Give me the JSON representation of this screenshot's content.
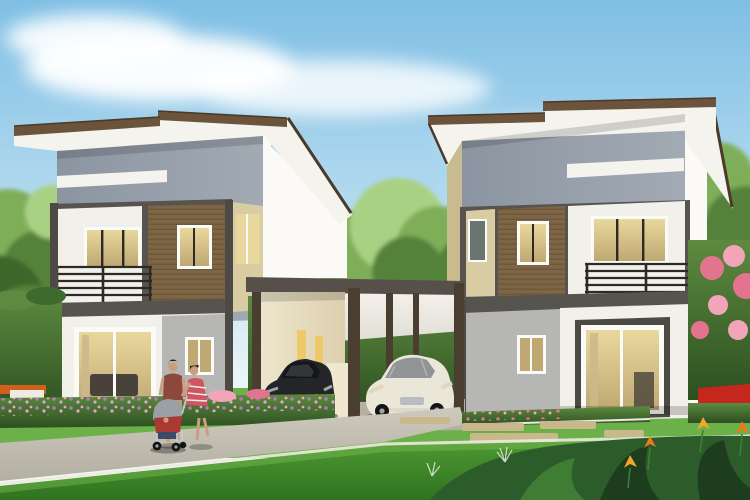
{
  "meta": {
    "type": "architectural-rendering",
    "subject": "Twin modern two-story houses with central carport, cars and family on walkway",
    "width_px": 750,
    "height_px": 500
  },
  "scene": {
    "sky": {
      "description": "light blue sky with soft clouds",
      "cloud_count": 4
    },
    "houses": [
      {
        "id": "left-house",
        "position": "left",
        "floors": 2,
        "features": [
          "brown-edged shed roof",
          "gray upper facade with white stripe",
          "balcony with dark railing",
          "wood-slat accent panel",
          "lit upper windows",
          "sliding glass door",
          "gray stucco section with small window"
        ]
      },
      {
        "id": "right-house",
        "position": "right",
        "floors": 2,
        "features": [
          "brown-edged shed roof",
          "gray upper facade with white stripe",
          "balcony with dark railing",
          "wood-slat accent panel",
          "lit upper windows",
          "dark-framed sliding glass door",
          "gray stucco section with small window"
        ]
      }
    ],
    "carport": {
      "position": "center",
      "posts": 5,
      "ceiling": "white",
      "vehicles": [
        "black sedan",
        "white sedan"
      ]
    },
    "people": [
      {
        "id": "man",
        "clothing": "maroon t-shirt and khaki shorts"
      },
      {
        "id": "woman",
        "clothing": "red-white striped dress"
      },
      {
        "id": "baby-stroller",
        "colors": "gray canopy, red seat, navy basket"
      }
    ],
    "landscaping": [
      "front lawn with white edging lines",
      "paved walkway",
      "purple flower bed",
      "tall left hedge with white garden steps and orange accents",
      "hedge behind carport",
      "pink flowering shrub",
      "red flower border",
      "orange heliconia plants",
      "stepping stones",
      "background trees"
    ]
  },
  "colors": {
    "sky_top": "#7fbfe4",
    "sky_mid": "#b9ddf1",
    "sky_low": "#e9f4f8",
    "sky_horizon": "#f4f8f3",
    "cloud": "#ffffff",
    "tree_light": "#a9d184",
    "tree_mid": "#7fae58",
    "tree_dark": "#55823b",
    "tree_deep": "#3c6629",
    "hedge_top": "#5d8a40",
    "hedge_mid": "#3f6a2e",
    "hedge_dark": "#2c4f20",
    "lawn_back": "#6cb04a",
    "lawn_mid": "#4f9a33",
    "lawn_front": "#2f731f",
    "lawn_stripe": "#7bbd55",
    "walk_light": "#cdc9bc",
    "walk_mid": "#b3afa2",
    "walk_dark": "#98948a",
    "curb_white": "#eceadf",
    "pave": "#b5b0a2",
    "roof_brown": "#6b543b",
    "roof_brown_dark": "#4b3a27",
    "roof_white": "#f5f3ed",
    "roof_shadow": "#dddbd2",
    "wall_gray": "#8b95a1",
    "wall_gray_light": "#a2aab4",
    "wall_white": "#f2f0ea",
    "wall_white_dim": "#e2dfd7",
    "corner_white": "#fbfaf6",
    "band_dark": "#57534e",
    "col_dark": "#4d4944",
    "wood": "#7d6546",
    "wood_dark": "#5c4a31",
    "beige": "#d9cca3",
    "beige_dim": "#c9bb90",
    "stucco": "#b6b7b5",
    "stucco_dim": "#a5a6a4",
    "frame_white": "#fafaf7",
    "glass_warm": "#e9d89e",
    "glass_warm_dark": "#bfa872",
    "glass_cool": "#8d9a90",
    "glass_dark": "#69756e",
    "rail_dark": "#2d2a26",
    "cream": "#efe7cf",
    "cream_dim": "#ddd0ae",
    "slit_glow": "#eec96a",
    "ceiling": "#f4f1ea",
    "carport_fascia": "#57504a",
    "post": "#4a3e30",
    "car_black": "#232529",
    "car_black_hi": "#42464c",
    "car_black_glass": "#14161a",
    "car_white": "#ebe7d8",
    "car_white_dim": "#cfcaba",
    "car_white_glass": "#8f9496",
    "wheel": "#141414",
    "hub": "#9fa3a7",
    "chrome": "#b9bdc1",
    "headlight": "#ded8c0",
    "skin": "#c99f7f",
    "hair": "#2a211c",
    "man_shirt": "#8a493c",
    "man_shorts": "#ada083",
    "dress_red": "#d05560",
    "dress_white": "#f0eee9",
    "stroller_red": "#aa3833",
    "stroller_gray": "#9aa0a3",
    "stroller_navy": "#3b4a69",
    "stroller_frame": "#c6c9cc",
    "flower_purple": "#b277bd",
    "flower_purple2": "#dca6d4",
    "flower_pink": "#e4738f",
    "flower_pink2": "#f2a4b8",
    "flower_red": "#c5271d",
    "flower_orange": "#ea7c1c",
    "flower_orange2": "#f5a42c",
    "plant_deep": "#1d3d1e",
    "plant_dark": "#2c5c2a",
    "plant_mid": "#3f7d35",
    "stone": "#c8b88c",
    "bench_white": "#edebe4",
    "bench_orange": "#d2601d",
    "sofa_dark": "#49423a",
    "interior_tan": "#cbb98c",
    "shadow": "#000000"
  }
}
